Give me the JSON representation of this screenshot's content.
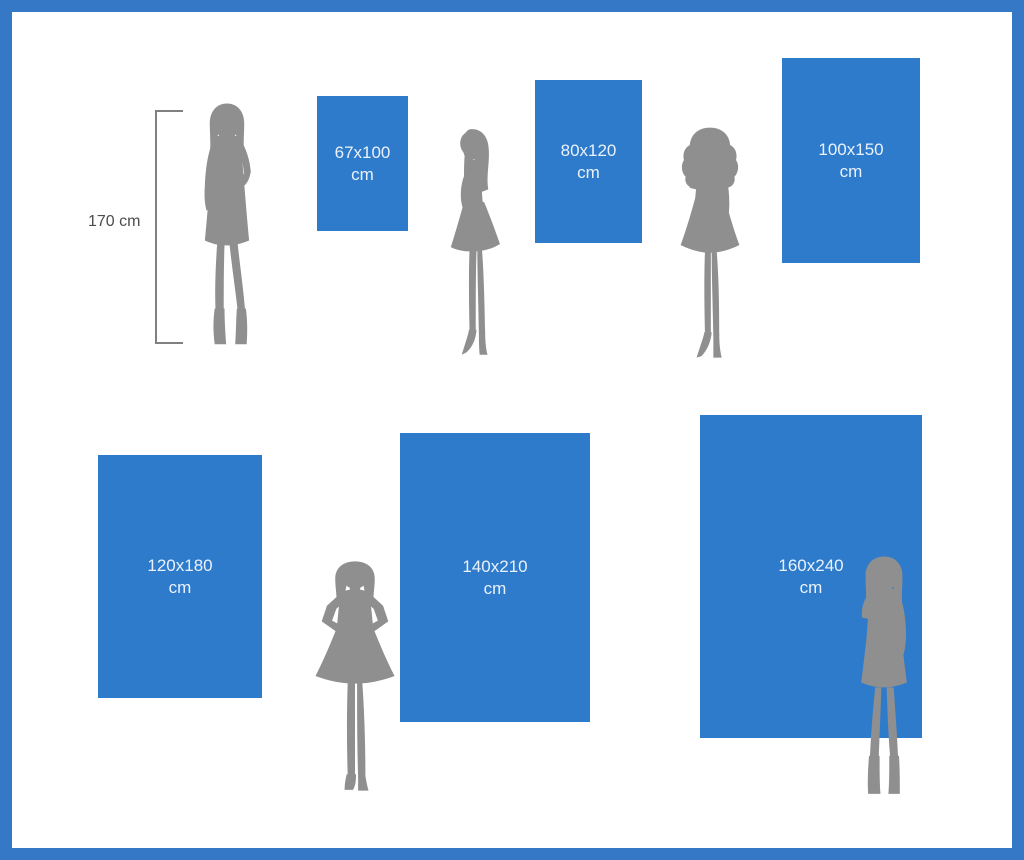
{
  "diagram_type": "size-comparison",
  "reference": {
    "label": "170 cm",
    "height_cm": 170
  },
  "sizes": [
    {
      "label": "67x100",
      "unit": "cm",
      "width_cm": 67,
      "height_cm": 100
    },
    {
      "label": "80x120",
      "unit": "cm",
      "width_cm": 80,
      "height_cm": 120
    },
    {
      "label": "100x150",
      "unit": "cm",
      "width_cm": 100,
      "height_cm": 150
    },
    {
      "label": "120x180",
      "unit": "cm",
      "width_cm": 120,
      "height_cm": 180
    },
    {
      "label": "140x210",
      "unit": "cm",
      "width_cm": 140,
      "height_cm": 210
    },
    {
      "label": "160x240",
      "unit": "cm",
      "width_cm": 160,
      "height_cm": 240
    }
  ],
  "figures": [
    {
      "name": "woman-silhouette-front-boots"
    },
    {
      "name": "woman-silhouette-profile-heels"
    },
    {
      "name": "woman-silhouette-curly-hair"
    },
    {
      "name": "woman-silhouette-hands-on-hips"
    },
    {
      "name": "woman-silhouette-hand-on-chin-boots"
    }
  ],
  "colors": {
    "frame_blue": "#3579c6",
    "rect_blue": "#2f7bcb",
    "rect_text": "#e9f2fb",
    "silhouette_gray": "#8f8f8f",
    "measure_line_gray": "#808080",
    "measure_text_gray": "#4c4c4c",
    "background": "#ffffff"
  }
}
